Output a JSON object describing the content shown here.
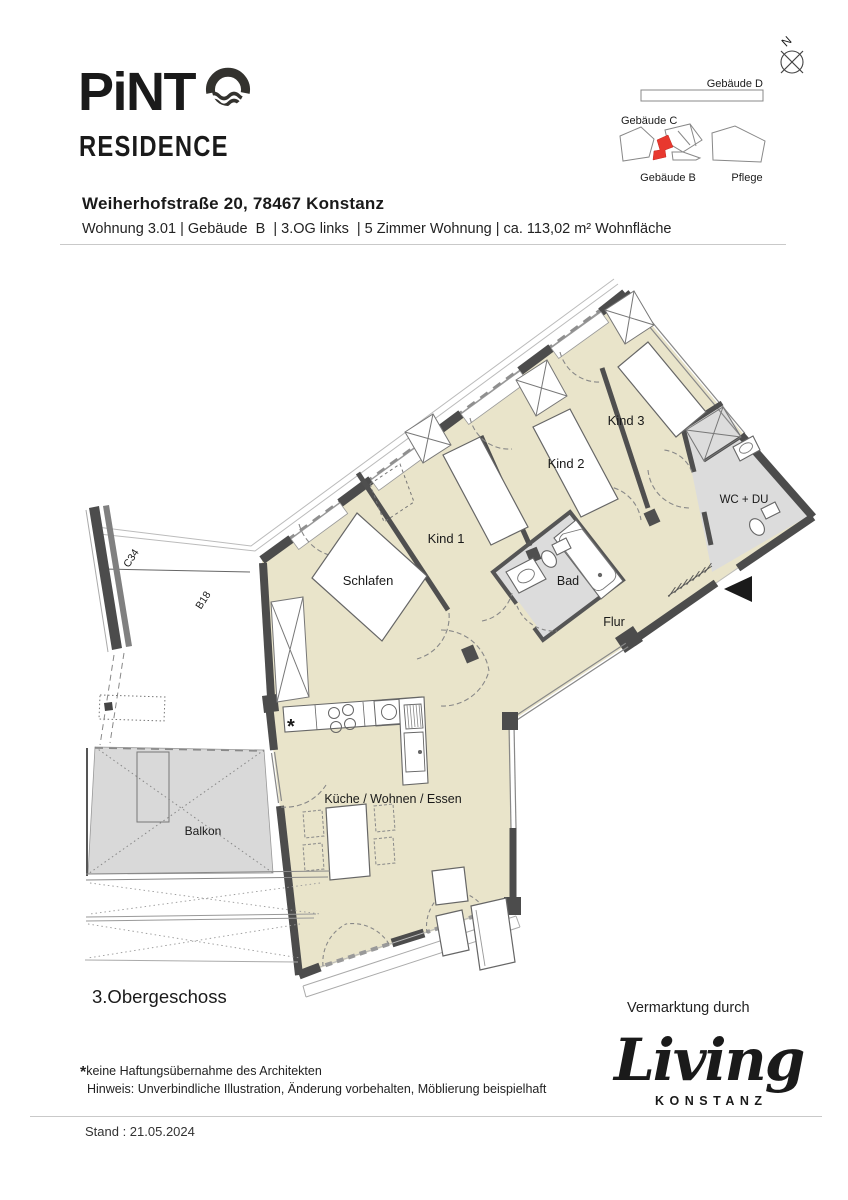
{
  "logo": {
    "brand": "PiNT",
    "residence": "RESIDENCE"
  },
  "site_map": {
    "compass": "N",
    "gebaeude_d": "Gebäude D",
    "gebaeude_c": "Gebäude C",
    "gebaeude_b": "Gebäude B",
    "pflege": "Pflege"
  },
  "header": {
    "address": "Weiherhofstraße 20, 78467 Konstanz",
    "details": "Wohnung 3.01 | Gebäude  B  | 3.OG links  | 5 Zimmer Wohnung | ca. 113,02 m² Wohnfläche"
  },
  "plan": {
    "rooms": {
      "schlafen": "Schlafen",
      "kind1": "Kind 1",
      "kind2": "Kind 2",
      "kind3": "Kind 3",
      "bad": "Bad",
      "wc": "WC + DU",
      "flur": "Flur",
      "kueche": "Küche / Wohnen / Essen",
      "balkon": "Balkon"
    },
    "unit_c34": "C34",
    "unit_b18": "B18",
    "floor": "3.Obergeschoss",
    "kitchen_asterisk": "*"
  },
  "footer": {
    "footnote_star": "*",
    "footnote1": "keine Haftungsübernahme des Architekten",
    "footnote2": "Hinweis: Unverbindliche Illustration, Änderung vorbehalten, Möblierung beispielhaft",
    "stand": "Stand : 21.05.2024",
    "marketing": "Vermarktung durch",
    "living_brand": "Living",
    "living_city": "KONSTANZ"
  },
  "colors": {
    "room_fill": "#e9e4ca",
    "wet_room_fill": "#dcdcdc",
    "balcony_fill": "#d9d9d9",
    "wall": "#4c4c4c",
    "highlight_red": "#e8382e",
    "living_green": "#9dae9e",
    "logo_ink": "#33322e"
  }
}
